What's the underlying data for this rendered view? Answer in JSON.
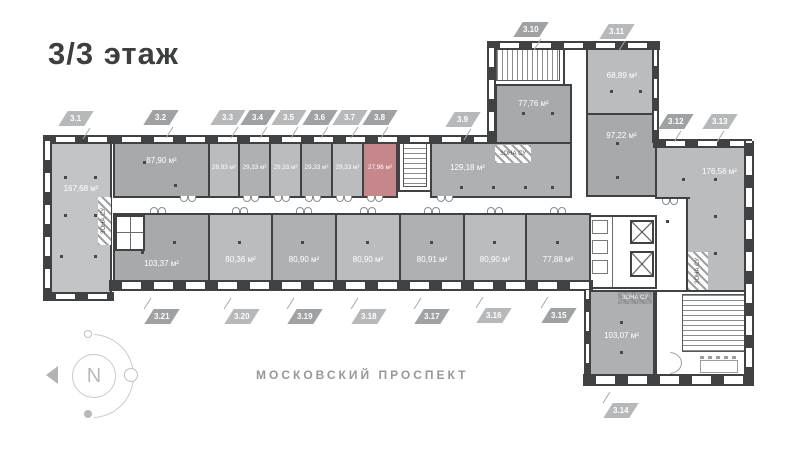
{
  "title": "3/3 этаж",
  "street_label": "МОСКОВСКИЙ ПРОСПЕКТ",
  "compass": {
    "north_label": "N"
  },
  "zone_label": "ЗОНА СУ",
  "colors": {
    "wall": "#3f4143",
    "room_dark": "#a7a9ab",
    "room_mid": "#aeb0b2",
    "room_light": "#babcbe",
    "room_xlight": "#c3c4c6",
    "highlight": "#c5878c",
    "badge": "#9fa1a3",
    "badge_light": "#b6b8ba",
    "muted_text": "#96989a"
  },
  "rooms": [
    {
      "id": "3.1",
      "area": "167,68 м²"
    },
    {
      "id": "3.2",
      "area": "87,90 м²"
    },
    {
      "id": "3.3",
      "area": "28,93 м²"
    },
    {
      "id": "3.4",
      "area": "29,33 м²"
    },
    {
      "id": "3.5",
      "area": "29,33 м²"
    },
    {
      "id": "3.6",
      "area": "29,33 м²"
    },
    {
      "id": "3.7",
      "area": "29,33 м²"
    },
    {
      "id": "3.8",
      "area": "27,96 м²",
      "selected": true
    },
    {
      "id": "3.9",
      "area": "129,18 м²"
    },
    {
      "id": "3.10",
      "area": "77,76 м²"
    },
    {
      "id": "3.11",
      "area": "68,89 м²"
    },
    {
      "id": "3.12",
      "area": "97,22 м²"
    },
    {
      "id": "3.13",
      "area": "176,56 м²"
    },
    {
      "id": "3.14",
      "area": "103,07 м²"
    },
    {
      "id": "3.15",
      "area": "77,88 м²"
    },
    {
      "id": "3.16",
      "area": "80,90 м²"
    },
    {
      "id": "3.17",
      "area": "80,91 м²"
    },
    {
      "id": "3.18",
      "area": "80,90 м²"
    },
    {
      "id": "3.19",
      "area": "80,90 м²"
    },
    {
      "id": "3.20",
      "area": "80,36 м²"
    },
    {
      "id": "3.21",
      "area": "103,37 м²"
    }
  ]
}
